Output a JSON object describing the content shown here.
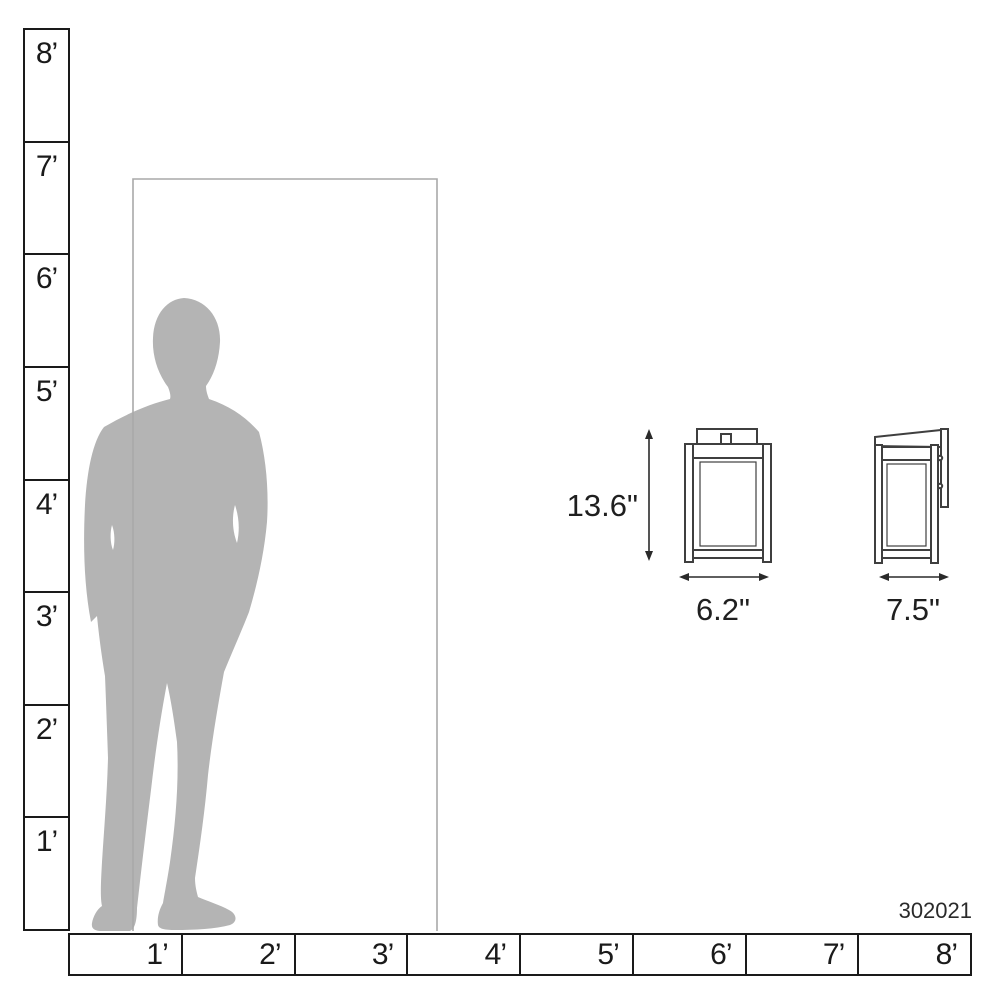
{
  "product_code": "302021",
  "scale": {
    "vertical_labels": [
      "8’",
      "7’",
      "6’",
      "5’",
      "4’",
      "3’",
      "2’",
      "1’"
    ],
    "horizontal_labels": [
      "1’",
      "2’",
      "3’",
      "4’",
      "5’",
      "6’",
      "7’",
      "8’"
    ]
  },
  "dimensions": {
    "height": "13.6\"",
    "width": "6.2\"",
    "depth": "7.5\""
  },
  "colors": {
    "silhouette_gray": "#b4b4b4",
    "door_outline_gray": "#a9a9a9",
    "scale_line": "#1a1a1a",
    "drawing_line": "#3f3f3f",
    "text": "#1a1a1a"
  },
  "icons": {
    "person": "person-silhouette",
    "door": "door-outline",
    "front_view": "lantern-front-view",
    "side_view": "lantern-side-view",
    "height_arrow": "double-arrow-vertical",
    "width_arrow": "double-arrow-horizontal"
  }
}
